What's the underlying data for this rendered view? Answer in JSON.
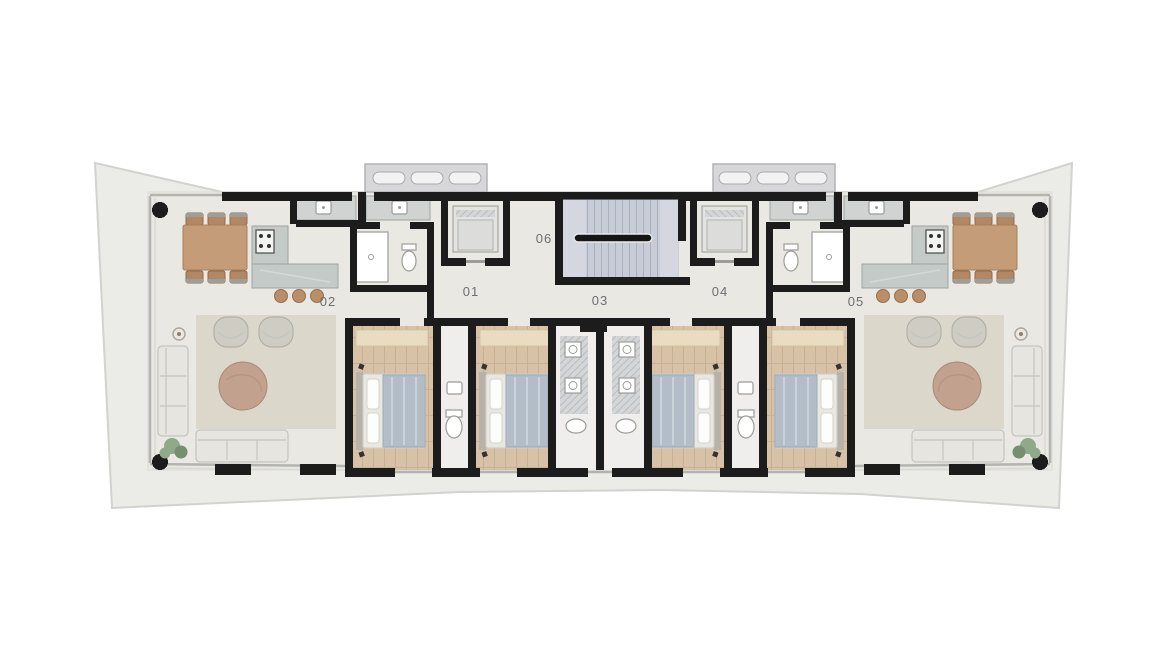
{
  "title": "Residential building floor plan (top view)",
  "labels": {
    "u01": "01",
    "u02": "02",
    "u03": "03",
    "u04": "04",
    "u05": "05",
    "u06": "06"
  },
  "colors": {
    "bg": "#ffffff",
    "wall": "#1c1c1c",
    "slab": "#ebebe8",
    "slab-edge": "#d2d2ce",
    "floor": "#e9e8e3",
    "floor-edge": "#dcdbd6",
    "wood": "#d8c2a7",
    "wood-line": "#c8b092",
    "closet": "#e9dcc0",
    "table": "#c49c78",
    "chair": "#b28761",
    "stool": "#b98e68",
    "counter": "#c4cac8",
    "counter-edge": "#9da4a1",
    "stair": "#c8ccd6",
    "stair-line": "#aab0bf",
    "rug": "#dcd7cb",
    "sofa": "#e7e5e0",
    "sofa-edge": "#c6c4be",
    "armchair": "#cfccc3",
    "blanket": "#b2bdc8",
    "mattress": "#e9e7e2",
    "fixture": "#ffffff",
    "fixture-edge": "#9b9b98",
    "glazing": "#b3b3b0",
    "plant": "#8faa88",
    "plant-dark": "#76906f",
    "ottoman": "#c2a18e",
    "vent": "#d7d7d9",
    "vent-slot": "#f2f2f2",
    "elevator": "#e3e3e1",
    "shaft-floor": "#efeeec",
    "label": "#6e6f72"
  },
  "icon_shapes": {
    "dining-table": "rect",
    "dining-chair": "rounded-rect",
    "kitchen-counter": "L-rect",
    "cooktop-icon": "rect-with-dots",
    "bar-stool": "circle",
    "sofa": "rounded-rect",
    "armchair": "rounded-rect",
    "area-rug": "rect",
    "round-ottoman": "circle",
    "plant-icon": "circle-cluster",
    "floor-lamp-icon": "double-circle",
    "bed": "rect-with-pillows",
    "closet": "strip-rect",
    "sink-icon": "small-square",
    "toilet-icon": "ellipse",
    "shower": "rect",
    "washer-icon": "square-with-circle",
    "staircase": "striped-rect",
    "handrail": "black-pill",
    "elevator": "nested-squares",
    "structural-column": "black-circle",
    "vent-grille": "slotted-rect",
    "window-glazing": "double-line"
  }
}
